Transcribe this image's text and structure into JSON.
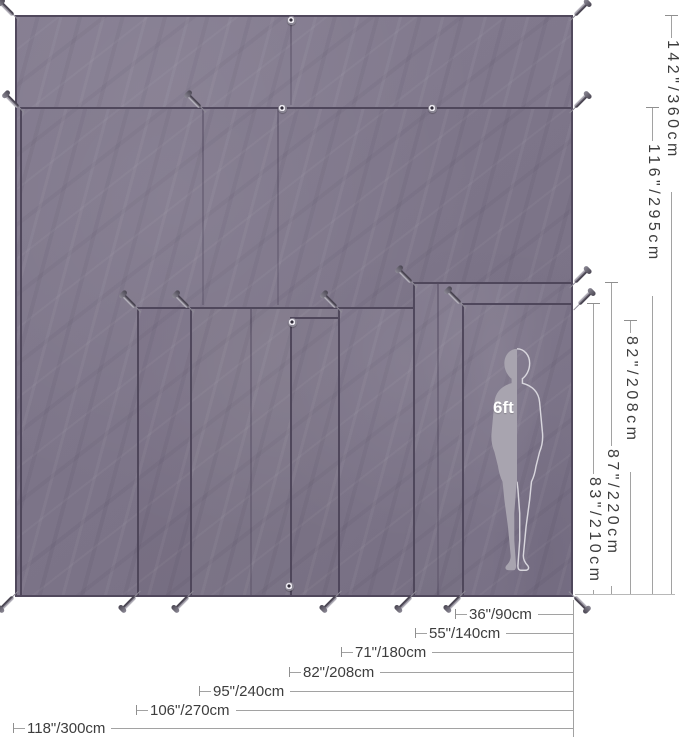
{
  "diagram": {
    "type": "tarp-size-comparison",
    "figure": {
      "label": "6ft"
    },
    "colors": {
      "tarp_base": "#7b7387",
      "tarp_edge": "#42394e",
      "silhouette_fill": "#a8a4af",
      "silhouette_outline": "#d8d6dd",
      "dimension_line": "#a2a2a2",
      "dimension_text": "#3d3d3d",
      "background": "#ffffff"
    },
    "dims": {
      "vertical": [
        {
          "label": "142\"/360cm"
        },
        {
          "label": "116\"/295cm"
        },
        {
          "label": "82\"/208cm"
        },
        {
          "label": "87\"/220cm"
        },
        {
          "label": "83\"/210cm"
        }
      ],
      "horizontal": [
        {
          "label": "36\"/90cm"
        },
        {
          "label": "55\"/140cm"
        },
        {
          "label": "71\"/180cm"
        },
        {
          "label": "82\"/208cm"
        },
        {
          "label": "95\"/240cm"
        },
        {
          "label": "106\"/270cm"
        },
        {
          "label": "118\"/300cm"
        }
      ]
    }
  }
}
